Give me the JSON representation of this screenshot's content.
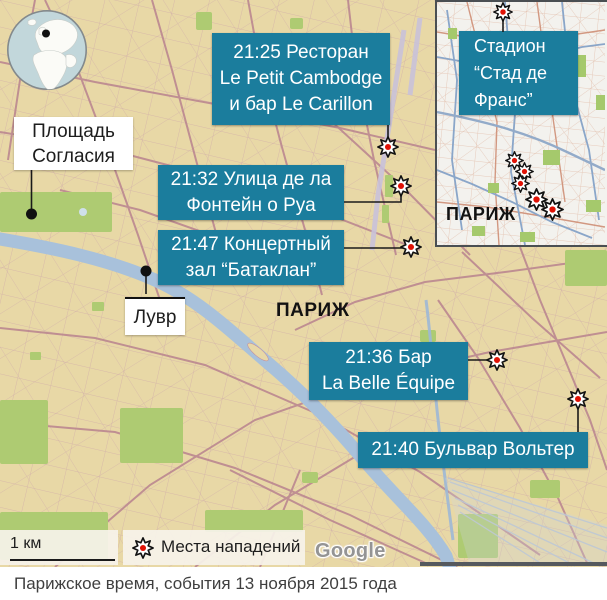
{
  "colors": {
    "accent_teal": "#1b7d9d",
    "map_background": "#e8d8a6",
    "street_pink": "#bf8f9e",
    "park_green": "#aecb72",
    "river_blue": "#a8c1db",
    "burst_red": "#e01206",
    "inset_background": "#f3f2ee"
  },
  "icons": {
    "attack_marker": "burst-icon",
    "locator_globe": "globe-icon",
    "place_marker": "dot-icon"
  },
  "labels": {
    "concorde_line1": "Площадь",
    "concorde_line2": "Согласия",
    "louvre": "Лувр",
    "city": "ПАРИЖ",
    "inset_city": "ПАРИЖ"
  },
  "callouts": [
    {
      "lines": [
        "21:25 Ресторан",
        "Le Petit Cambodge",
        "и бар Le Carillon"
      ]
    },
    {
      "lines": [
        "21:32 Улица де ла",
        "Фонтейн о Руа"
      ]
    },
    {
      "lines": [
        "21:47 Концертный",
        "зал “Батаклан”"
      ]
    },
    {
      "lines": [
        "21:36 Бар",
        "La Belle Équipe"
      ]
    },
    {
      "lines": [
        "21:40 Бульвар Вольтер"
      ]
    }
  ],
  "inset": {
    "stadium_line1": "Стадион",
    "stadium_line2": "“Стад де",
    "stadium_line3": "Франс”"
  },
  "legend": {
    "scale": "1 км",
    "attacks": "Места нападений",
    "watermark": "Google"
  },
  "caption": "Парижское время, события 13 ноября 2015 года"
}
